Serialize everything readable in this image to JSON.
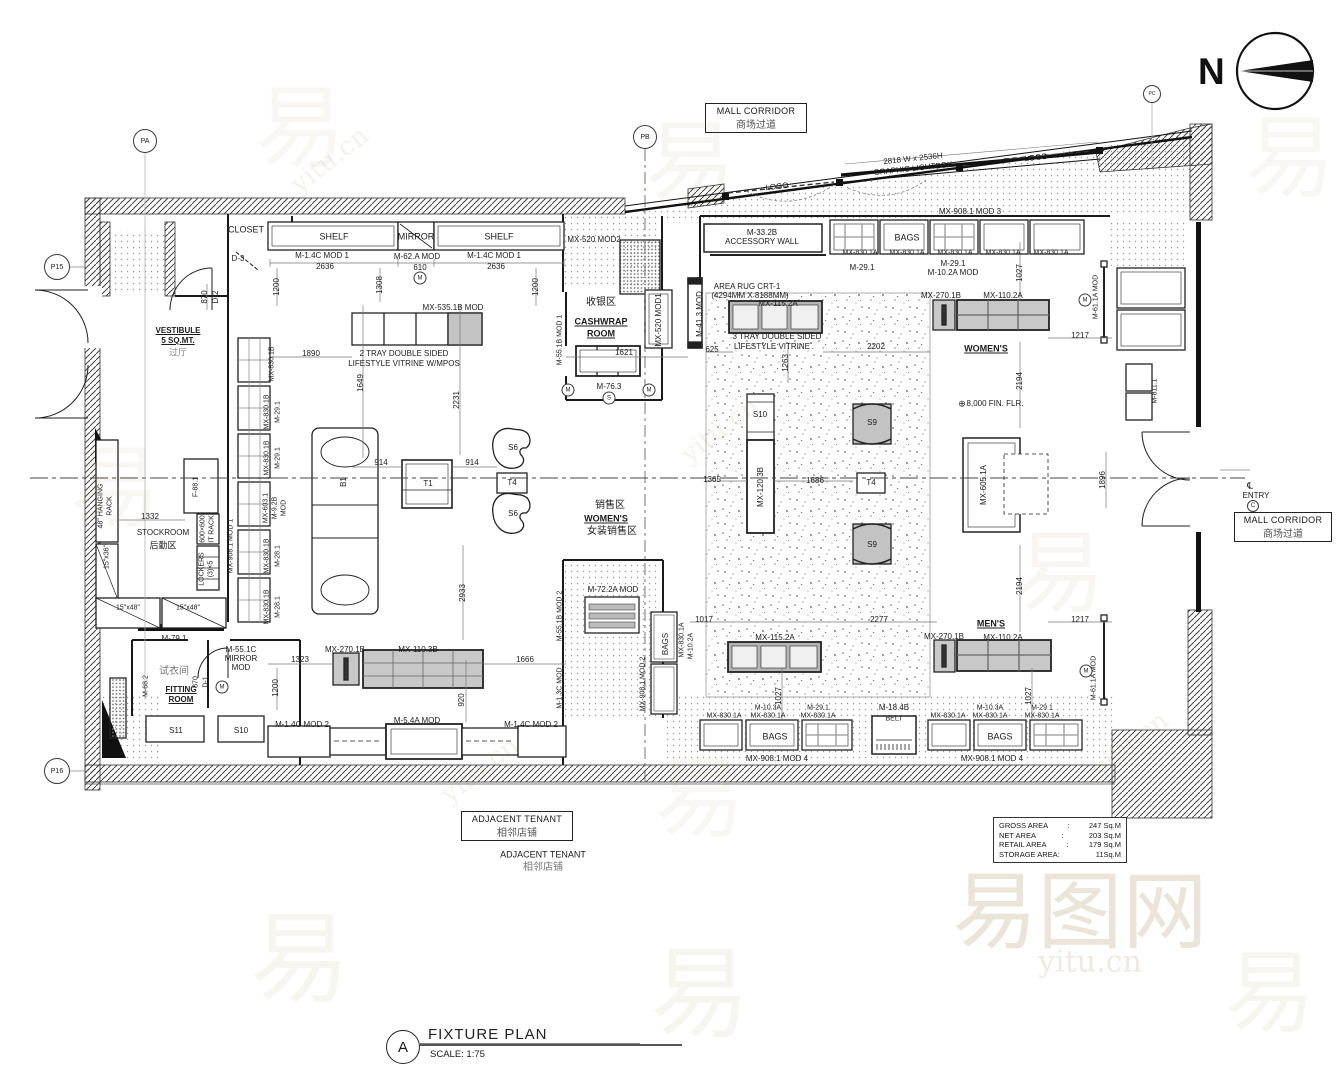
{
  "colors": {
    "line": "#1a1a1a",
    "fixture_gray": "#c8c8c8",
    "speckle": "#666666",
    "watermark": "#a98a52"
  },
  "north": {
    "letter": "N"
  },
  "boxed": {
    "mall_corridor": {
      "en": "MALL CORRIDOR",
      "zh": "商场过道"
    },
    "adjacent_tenant": {
      "en": "ADJACENT TENANT",
      "zh": "相邻店铺"
    }
  },
  "area_table": {
    "rows": [
      {
        "label": "GROSS AREA",
        "value": "247 Sq.M"
      },
      {
        "label": "NET AREA",
        "value": "203 Sq.M"
      },
      {
        "label": "RETAIL AREA",
        "value": "179 Sq.M"
      },
      {
        "label": "STORAGE AREA:",
        "value": "11Sq.M"
      }
    ]
  },
  "title_block": {
    "detail_letter": "A",
    "title": "FIXTURE PLAN",
    "scale": "SCALE: 1:75"
  },
  "plan": {
    "labels": [
      {
        "t": "2818 W x 2536H",
        "x": 913,
        "y": 159,
        "r": -6
      },
      {
        "t": "GRAPHIC LIGHTBOX",
        "x": 913,
        "y": 169,
        "r": -6
      },
      {
        "t": "LOGO",
        "x": 777,
        "y": 187,
        "r": -6
      },
      {
        "t": "LOGO",
        "x": 1036,
        "y": 158,
        "r": -6
      },
      {
        "t": "MX-908.1 MOD 3",
        "x": 970,
        "y": 212
      },
      {
        "t": "CLOSET",
        "x": 246,
        "y": 230,
        "s": 9
      },
      {
        "t": "D-3",
        "x": 238,
        "y": 259
      },
      {
        "t": "870",
        "x": 205,
        "y": 297,
        "r": -90
      },
      {
        "t": "D-2",
        "x": 216,
        "y": 297,
        "r": -90
      },
      {
        "t": "1200",
        "x": 277,
        "y": 287,
        "r": -90
      },
      {
        "t": "VESTIBULE",
        "x": 178,
        "y": 331,
        "b": 1,
        "u": 1
      },
      {
        "t": "5 SQ.MT.",
        "x": 178,
        "y": 341,
        "b": 1,
        "u": 1
      },
      {
        "t": "过厅",
        "x": 178,
        "y": 353,
        "s": 9,
        "c": "#888"
      },
      {
        "t": "SHELF",
        "x": 334,
        "y": 237,
        "s": 9
      },
      {
        "t": "MIRROR",
        "x": 416,
        "y": 237,
        "s": 9
      },
      {
        "t": "SHELF",
        "x": 499,
        "y": 237,
        "s": 9
      },
      {
        "t": "M-1.4C MOD 1",
        "x": 322,
        "y": 256
      },
      {
        "t": "2636",
        "x": 325,
        "y": 267
      },
      {
        "t": "M-62.A MOD",
        "x": 417,
        "y": 257
      },
      {
        "t": "610",
        "x": 420,
        "y": 268
      },
      {
        "t": "M-1.4C MOD 1",
        "x": 494,
        "y": 256
      },
      {
        "t": "2636",
        "x": 496,
        "y": 267
      },
      {
        "t": "1308",
        "x": 380,
        "y": 285,
        "r": -90
      },
      {
        "t": "1200",
        "x": 536,
        "y": 287,
        "r": -90
      },
      {
        "t": "MX-535.1B MOD",
        "x": 453,
        "y": 308
      },
      {
        "t": "MX-520 MOD2",
        "x": 594,
        "y": 240
      },
      {
        "t": "收银区",
        "x": 601,
        "y": 303,
        "s": 10
      },
      {
        "t": "CASHWRAP",
        "x": 601,
        "y": 322,
        "s": 9,
        "b": 1,
        "u": 1
      },
      {
        "t": "ROOM",
        "x": 601,
        "y": 334,
        "s": 9,
        "b": 1,
        "u": 1
      },
      {
        "t": "MX-520 MOD1",
        "x": 659,
        "y": 320,
        "r": -90
      },
      {
        "t": "M-55.1B MOD 1",
        "x": 560,
        "y": 340,
        "r": -90,
        "s": 7
      },
      {
        "t": "M-41.3 MOD",
        "x": 700,
        "y": 314,
        "r": -90
      },
      {
        "t": "M-76.3",
        "x": 609,
        "y": 387
      },
      {
        "t": "1890",
        "x": 311,
        "y": 354
      },
      {
        "t": "2 TRAY DOUBLE SIDED",
        "x": 404,
        "y": 354
      },
      {
        "t": "LIFESTYLE VITRINE W/MPOS",
        "x": 404,
        "y": 364
      },
      {
        "t": "1621",
        "x": 624,
        "y": 353
      },
      {
        "t": "1649",
        "x": 361,
        "y": 383,
        "r": -90
      },
      {
        "t": "2231",
        "x": 457,
        "y": 400,
        "r": -90
      },
      {
        "t": "914",
        "x": 381,
        "y": 463
      },
      {
        "t": "914",
        "x": 472,
        "y": 463
      },
      {
        "t": "B1",
        "x": 344,
        "y": 482,
        "r": -90
      },
      {
        "t": "T1",
        "x": 428,
        "y": 484
      },
      {
        "t": "S6",
        "x": 513,
        "y": 448
      },
      {
        "t": "T4",
        "x": 512,
        "y": 483
      },
      {
        "t": "S6",
        "x": 513,
        "y": 514
      },
      {
        "t": "销售区",
        "x": 610,
        "y": 506,
        "s": 10
      },
      {
        "t": "WOMEN'S",
        "x": 606,
        "y": 519,
        "s": 9,
        "b": 1,
        "u": 1
      },
      {
        "t": "女装销售区",
        "x": 612,
        "y": 532,
        "s": 10
      },
      {
        "t": "2933",
        "x": 463,
        "y": 593,
        "r": -90
      },
      {
        "t": "MX-830.1B",
        "x": 272,
        "y": 364,
        "r": -90,
        "s": 7
      },
      {
        "t": "MX-830.1B",
        "x": 267,
        "y": 412,
        "r": -90,
        "s": 7
      },
      {
        "t": "M-29.1",
        "x": 278,
        "y": 412,
        "r": -90,
        "s": 7
      },
      {
        "t": "MX-830.1B",
        "x": 267,
        "y": 458,
        "r": -90,
        "s": 7
      },
      {
        "t": "M-29.1",
        "x": 278,
        "y": 458,
        "r": -90,
        "s": 7
      },
      {
        "t": "MX-603.1",
        "x": 266,
        "y": 508,
        "r": -90,
        "s": 7
      },
      {
        "t": "M-9.2B",
        "x": 275,
        "y": 508,
        "r": -90,
        "s": 7
      },
      {
        "t": "MOD",
        "x": 284,
        "y": 508,
        "r": -90,
        "s": 7
      },
      {
        "t": "MX-830.1B",
        "x": 267,
        "y": 556,
        "r": -90,
        "s": 7
      },
      {
        "t": "M-28.1",
        "x": 278,
        "y": 556,
        "r": -90,
        "s": 7
      },
      {
        "t": "MX-830.1B",
        "x": 267,
        "y": 607,
        "r": -90,
        "s": 7
      },
      {
        "t": "M-28.1",
        "x": 278,
        "y": 607,
        "r": -90,
        "s": 7
      },
      {
        "t": "1332",
        "x": 150,
        "y": 517
      },
      {
        "t": "STOCKROOM",
        "x": 163,
        "y": 533
      },
      {
        "t": "后勤区",
        "x": 163,
        "y": 546,
        "s": 9
      },
      {
        "t": "48\" HANGING",
        "x": 101,
        "y": 506,
        "r": -90,
        "s": 7
      },
      {
        "t": "RACK",
        "x": 110,
        "y": 506,
        "r": -90,
        "s": 7
      },
      {
        "t": "F-88.1",
        "x": 196,
        "y": 487,
        "r": -90,
        "s": 7
      },
      {
        "t": "600×600",
        "x": 203,
        "y": 529,
        "r": -90,
        "s": 7
      },
      {
        "t": "IT RACK",
        "x": 212,
        "y": 529,
        "r": -90,
        "s": 7
      },
      {
        "t": "LOCKERS",
        "x": 202,
        "y": 569,
        "r": -90,
        "s": 7
      },
      {
        "t": "(3)×5",
        "x": 211,
        "y": 569,
        "r": -90,
        "s": 7
      },
      {
        "t": "15\"x36\"",
        "x": 107,
        "y": 557,
        "r": -90,
        "s": 7
      },
      {
        "t": "15\"x48\"",
        "x": 128,
        "y": 608,
        "s": 7
      },
      {
        "t": "15\"x48\"",
        "x": 188,
        "y": 608,
        "s": 7
      },
      {
        "t": "MX-908.1 MOD 1",
        "x": 231,
        "y": 546,
        "r": -90,
        "s": 7
      },
      {
        "t": "M-79.1",
        "x": 174,
        "y": 639
      },
      {
        "t": "M-68.2",
        "x": 146,
        "y": 686,
        "r": -90,
        "s": 7
      },
      {
        "t": "试衣间",
        "x": 174,
        "y": 672,
        "s": 10,
        "c": "#777"
      },
      {
        "t": "FITTING",
        "x": 181,
        "y": 690,
        "b": 1,
        "u": 1
      },
      {
        "t": "ROOM",
        "x": 181,
        "y": 700,
        "b": 1,
        "u": 1
      },
      {
        "t": "M-55.1C",
        "x": 241,
        "y": 650
      },
      {
        "t": "MIRROR",
        "x": 241,
        "y": 659
      },
      {
        "t": "MOD",
        "x": 241,
        "y": 668
      },
      {
        "t": "870",
        "x": 196,
        "y": 682,
        "r": -90,
        "s": 7
      },
      {
        "t": "D-1",
        "x": 206,
        "y": 682,
        "r": -90,
        "s": 7
      },
      {
        "t": "1200",
        "x": 276,
        "y": 688,
        "r": -90
      },
      {
        "t": "S11",
        "x": 176,
        "y": 731
      },
      {
        "t": "S10",
        "x": 241,
        "y": 731
      },
      {
        "t": "MX-270.1B",
        "x": 345,
        "y": 650
      },
      {
        "t": "MX-110.3B",
        "x": 418,
        "y": 650
      },
      {
        "t": "1323",
        "x": 300,
        "y": 660
      },
      {
        "t": "1666",
        "x": 525,
        "y": 660
      },
      {
        "t": "920",
        "x": 462,
        "y": 700,
        "r": -90
      },
      {
        "t": "M-1.4C MOD 2",
        "x": 302,
        "y": 725
      },
      {
        "t": "M-5.4A MOD",
        "x": 417,
        "y": 721
      },
      {
        "t": "M-1.4C MOD 2",
        "x": 531,
        "y": 725
      },
      {
        "t": "M-1.3C MOD",
        "x": 560,
        "y": 688,
        "r": -90,
        "s": 7
      },
      {
        "t": "M-72.2A MOD",
        "x": 613,
        "y": 590
      },
      {
        "t": "M-55.1B MOD 2",
        "x": 560,
        "y": 616,
        "r": -90,
        "s": 7
      },
      {
        "t": "MX-908.1 MOD 2",
        "x": 643,
        "y": 684,
        "r": -90,
        "s": 7
      },
      {
        "t": "BAGS",
        "x": 666,
        "y": 644,
        "r": -90
      },
      {
        "t": "MX-830.1A",
        "x": 682,
        "y": 640,
        "r": -90,
        "s": 7
      },
      {
        "t": "M-10.2A",
        "x": 691,
        "y": 646,
        "r": -90,
        "s": 7
      },
      {
        "t": "M-33.2B",
        "x": 762,
        "y": 233
      },
      {
        "t": "ACCESSORY WALL",
        "x": 762,
        "y": 242
      },
      {
        "t": "BAGS",
        "x": 907,
        "y": 238,
        "s": 9
      },
      {
        "t": "MX-830.1A",
        "x": 860,
        "y": 253,
        "s": 7
      },
      {
        "t": "MX-830.1A",
        "x": 907,
        "y": 253,
        "s": 7
      },
      {
        "t": "MX-830.1A",
        "x": 955,
        "y": 253,
        "s": 7
      },
      {
        "t": "MX-830.1A",
        "x": 1003,
        "y": 253,
        "s": 7
      },
      {
        "t": "MX-830.1A",
        "x": 1051,
        "y": 253,
        "s": 7
      },
      {
        "t": "M-29.1",
        "x": 862,
        "y": 268
      },
      {
        "t": "M-29.1",
        "x": 953,
        "y": 264
      },
      {
        "t": "M-10.2A MOD",
        "x": 953,
        "y": 273
      },
      {
        "t": "1027",
        "x": 1020,
        "y": 273,
        "r": -90
      },
      {
        "t": "AREA RUG CRT-1",
        "x": 747,
        "y": 287
      },
      {
        "t": "(4294MM X 8188MM)",
        "x": 750,
        "y": 296
      },
      {
        "t": "MX-115.2A",
        "x": 778,
        "y": 304
      },
      {
        "t": "MX-270.1B",
        "x": 941,
        "y": 296
      },
      {
        "t": "MX-110.2A",
        "x": 1003,
        "y": 296
      },
      {
        "t": "3 TRAY DOUBLE SIDED",
        "x": 777,
        "y": 337
      },
      {
        "t": "LIFESTYLE VITRINE",
        "x": 772,
        "y": 347
      },
      {
        "t": "625",
        "x": 712,
        "y": 350
      },
      {
        "t": "2202",
        "x": 876,
        "y": 347
      },
      {
        "t": "1263",
        "x": 786,
        "y": 363,
        "r": -90
      },
      {
        "t": "WOMEN'S",
        "x": 986,
        "y": 349,
        "s": 9,
        "b": 1,
        "u": 1
      },
      {
        "t": "M-61.1A MOD",
        "x": 1096,
        "y": 297,
        "r": -90,
        "s": 7
      },
      {
        "t": "1217",
        "x": 1080,
        "y": 336
      },
      {
        "t": "2194",
        "x": 1020,
        "y": 381,
        "r": -90
      },
      {
        "t": "⊕",
        "x": 962,
        "y": 404,
        "s": 9
      },
      {
        "t": "8,000 FIN. FLR.",
        "x": 995,
        "y": 404
      },
      {
        "t": "M-811.1",
        "x": 1155,
        "y": 391,
        "r": -90,
        "s": 7
      },
      {
        "t": "1896",
        "x": 1103,
        "y": 480,
        "r": -90
      },
      {
        "t": "S10",
        "x": 760,
        "y": 415
      },
      {
        "t": "MX-120.3B",
        "x": 761,
        "y": 487,
        "r": -90
      },
      {
        "t": "S9",
        "x": 872,
        "y": 423
      },
      {
        "t": "T4",
        "x": 871,
        "y": 483
      },
      {
        "t": "S9",
        "x": 872,
        "y": 545
      },
      {
        "t": "1365",
        "x": 712,
        "y": 480
      },
      {
        "t": "1686",
        "x": 815,
        "y": 481
      },
      {
        "t": "MX-605.1A",
        "x": 984,
        "y": 485,
        "r": -90
      },
      {
        "t": "2194",
        "x": 1020,
        "y": 586,
        "r": -90
      },
      {
        "t": "MEN'S",
        "x": 991,
        "y": 624,
        "s": 9,
        "b": 1,
        "u": 1
      },
      {
        "t": "1017",
        "x": 704,
        "y": 620
      },
      {
        "t": "2277",
        "x": 879,
        "y": 620
      },
      {
        "t": "1217",
        "x": 1080,
        "y": 620
      },
      {
        "t": "MX-115.2A",
        "x": 775,
        "y": 638
      },
      {
        "t": "MX-270.1B",
        "x": 944,
        "y": 637
      },
      {
        "t": "MX-110.2A",
        "x": 1003,
        "y": 638
      },
      {
        "t": "M-61.1A MOD",
        "x": 1094,
        "y": 678,
        "r": -90,
        "s": 7
      },
      {
        "t": "1027",
        "x": 779,
        "y": 696,
        "r": -90
      },
      {
        "t": "1027",
        "x": 1029,
        "y": 696,
        "r": -90
      },
      {
        "t": "MX-830.1A",
        "x": 724,
        "y": 716,
        "s": 7
      },
      {
        "t": "M-10.3A",
        "x": 768,
        "y": 708,
        "s": 7
      },
      {
        "t": "MX-830.1A",
        "x": 768,
        "y": 716,
        "s": 7
      },
      {
        "t": "M-29.1",
        "x": 818,
        "y": 708,
        "s": 7
      },
      {
        "t": "MX-830.1A",
        "x": 818,
        "y": 716,
        "s": 7
      },
      {
        "t": "BAGS",
        "x": 775,
        "y": 737,
        "s": 9
      },
      {
        "t": "M-18.4B",
        "x": 894,
        "y": 708
      },
      {
        "t": "BELT",
        "x": 894,
        "y": 719,
        "s": 7
      },
      {
        "t": "MX-830.1A",
        "x": 948,
        "y": 716,
        "s": 7
      },
      {
        "t": "M-10.3A",
        "x": 990,
        "y": 708,
        "s": 7
      },
      {
        "t": "MX-830.1A",
        "x": 990,
        "y": 716,
        "s": 7
      },
      {
        "t": "M-29.1",
        "x": 1042,
        "y": 708,
        "s": 7
      },
      {
        "t": "MX-830.1A",
        "x": 1042,
        "y": 716,
        "s": 7
      },
      {
        "t": "BAGS",
        "x": 1000,
        "y": 737,
        "s": 9
      },
      {
        "t": "MX-908.1 MOD 4",
        "x": 777,
        "y": 759
      },
      {
        "t": "MX-908.1 MOD 4",
        "x": 992,
        "y": 759
      },
      {
        "t": "℄",
        "x": 1250,
        "y": 486,
        "s": 9
      },
      {
        "t": "ENTRY",
        "x": 1256,
        "y": 496
      },
      {
        "t": "ADJACENT TENANT",
        "x": 543,
        "y": 855,
        "s": 9
      },
      {
        "t": "相邻店铺",
        "x": 543,
        "y": 868,
        "s": 10,
        "c": "#777"
      }
    ],
    "bubbles": [
      {
        "t": "PA",
        "x": 145,
        "y": 141,
        "d": 22,
        "s": 7
      },
      {
        "t": "PB",
        "x": 645,
        "y": 137,
        "d": 22,
        "s": 7
      },
      {
        "t": "PC",
        "x": 1152,
        "y": 94,
        "d": 16,
        "s": 5
      },
      {
        "t": "P15",
        "x": 57,
        "y": 267,
        "d": 24,
        "s": 7
      },
      {
        "t": "P16",
        "x": 57,
        "y": 771,
        "d": 24,
        "s": 7
      },
      {
        "t": "M",
        "x": 420,
        "y": 278,
        "d": 11,
        "s": 6
      },
      {
        "t": "M",
        "x": 568,
        "y": 390,
        "d": 11,
        "s": 6
      },
      {
        "t": "M",
        "x": 649,
        "y": 390,
        "d": 11,
        "s": 6
      },
      {
        "t": "S",
        "x": 609,
        "y": 398,
        "d": 11,
        "s": 6
      },
      {
        "t": "M",
        "x": 1085,
        "y": 300,
        "d": 11,
        "s": 6
      },
      {
        "t": "M",
        "x": 1086,
        "y": 671,
        "d": 11,
        "s": 6
      },
      {
        "t": "M",
        "x": 222,
        "y": 687,
        "d": 11,
        "s": 6
      },
      {
        "t": "C",
        "x": 1253,
        "y": 506,
        "d": 10,
        "s": 6
      }
    ],
    "watermarks": [
      {
        "t": "易",
        "x": 300,
        "y": 120,
        "s": 90,
        "o": 0.06
      },
      {
        "t": "易",
        "x": 690,
        "y": 155,
        "s": 90,
        "o": 0.07
      },
      {
        "t": "易",
        "x": 1290,
        "y": 150,
        "s": 90,
        "o": 0.06
      },
      {
        "t": "yitu.cn",
        "x": 330,
        "y": 160,
        "s": 26,
        "o": 0.1,
        "r": -38
      },
      {
        "t": "易",
        "x": 115,
        "y": 480,
        "s": 90,
        "o": 0.06
      },
      {
        "t": "yitu.cn",
        "x": 720,
        "y": 430,
        "s": 26,
        "o": 0.1,
        "r": -38
      },
      {
        "t": "易",
        "x": 1060,
        "y": 565,
        "s": 90,
        "o": 0.07
      },
      {
        "t": "易",
        "x": 700,
        "y": 790,
        "s": 90,
        "o": 0.06
      },
      {
        "t": "yitu.cn",
        "x": 480,
        "y": 770,
        "s": 26,
        "o": 0.1,
        "r": -38
      },
      {
        "t": "易",
        "x": 300,
        "y": 950,
        "s": 100,
        "o": 0.08
      },
      {
        "t": "易",
        "x": 700,
        "y": 985,
        "s": 100,
        "o": 0.08
      },
      {
        "t": "易图网",
        "x": 1080,
        "y": 905,
        "s": 85,
        "o": 0.22
      },
      {
        "t": "yitu.cn",
        "x": 1090,
        "y": 962,
        "s": 30,
        "o": 0.18
      },
      {
        "t": "易",
        "x": 1270,
        "y": 985,
        "s": 90,
        "o": 0.08
      },
      {
        "t": "yitu.cn",
        "x": 1130,
        "y": 745,
        "s": 26,
        "o": 0.12,
        "r": -38
      }
    ]
  }
}
